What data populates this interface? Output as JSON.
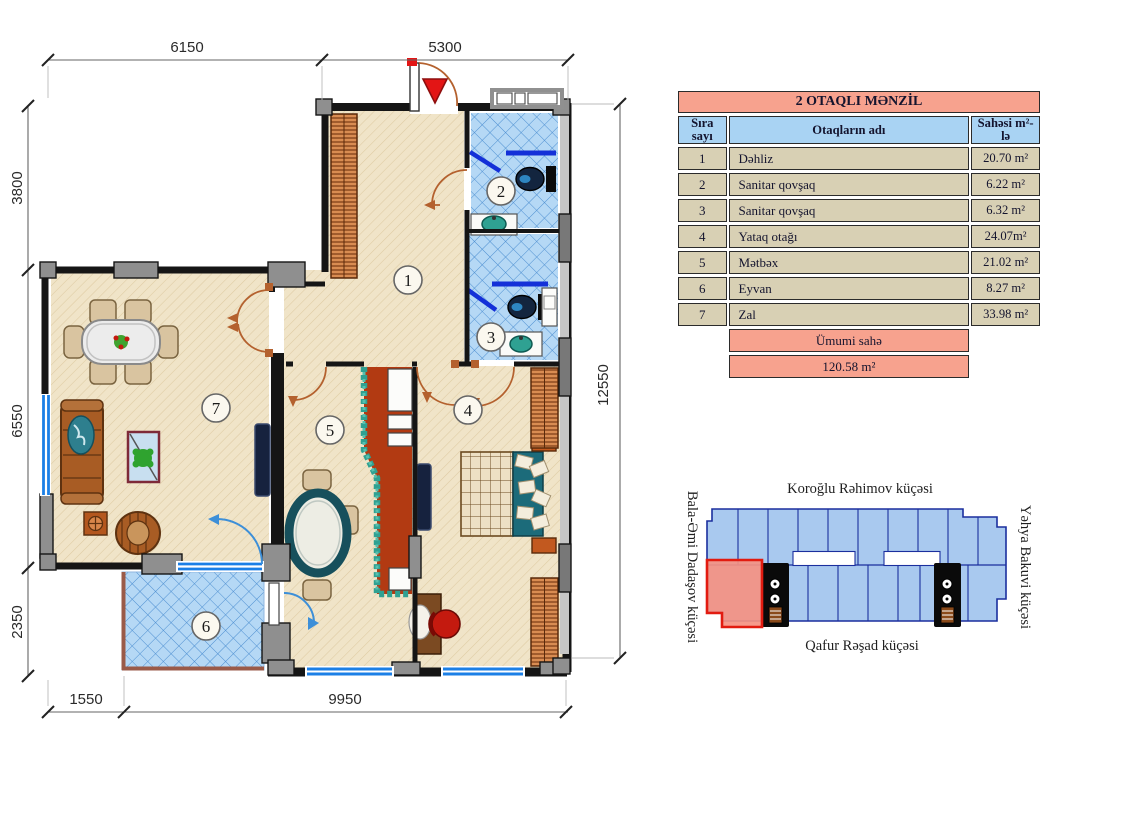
{
  "floor_plan": {
    "dimensions": {
      "top_left": "6150",
      "top_right": "5300",
      "left_top": "3800",
      "left_middle": "6550",
      "left_bottom": "2350",
      "right_full": "12550",
      "bottom_left": "1550",
      "bottom_right": "9950"
    },
    "rooms": [
      "1",
      "2",
      "3",
      "4",
      "5",
      "6",
      "7"
    ]
  },
  "table": {
    "title": "2 OTAQLI MƏNZİL",
    "columns": {
      "no": "Sıra sayı",
      "name": "Otaqların adı",
      "area": "Sahəsi m²-lə"
    },
    "rows": [
      {
        "no": "1",
        "name": "Dəhliz",
        "area": "20.70 m²"
      },
      {
        "no": "2",
        "name": "Sanitar qovşaq",
        "area": "6.22 m²"
      },
      {
        "no": "3",
        "name": "Sanitar qovşaq",
        "area": "6.32 m²"
      },
      {
        "no": "4",
        "name": "Yataq otağı",
        "area": "24.07m²"
      },
      {
        "no": "5",
        "name": "Mətbəx",
        "area": "21.02 m²"
      },
      {
        "no": "6",
        "name": "Eyvan",
        "area": "8.27 m²"
      },
      {
        "no": "7",
        "name": "Zal",
        "area": "33.98 m²"
      }
    ],
    "total_label": "Ümumi sahə",
    "total_value": "120.58 m²"
  },
  "site_map": {
    "street_top": "Koroğlu Rəhimov küçəsi",
    "street_bottom": "Qafur Rəşad küçəsi",
    "street_left": "Bala-Əmi Dadaşov küçəsi",
    "street_right": "Yəhya Bakuvi küçəsi"
  },
  "colors": {
    "table_title_bg": "#F7A28E",
    "table_header_bg": "#A9D3F3",
    "table_row_bg": "#D8D0B4",
    "floor_beige": "#F0E4C8",
    "tile_blue": "#B5D8F5",
    "window_blue": "#1B7FE6",
    "door_brown": "#B4612E",
    "counter_red": "#B23A12",
    "counter_teal": "#2FA192",
    "site_building_fill": "#A9C9EF",
    "site_building_line": "#1B2F9E",
    "site_unit_red": "#E21B10"
  }
}
